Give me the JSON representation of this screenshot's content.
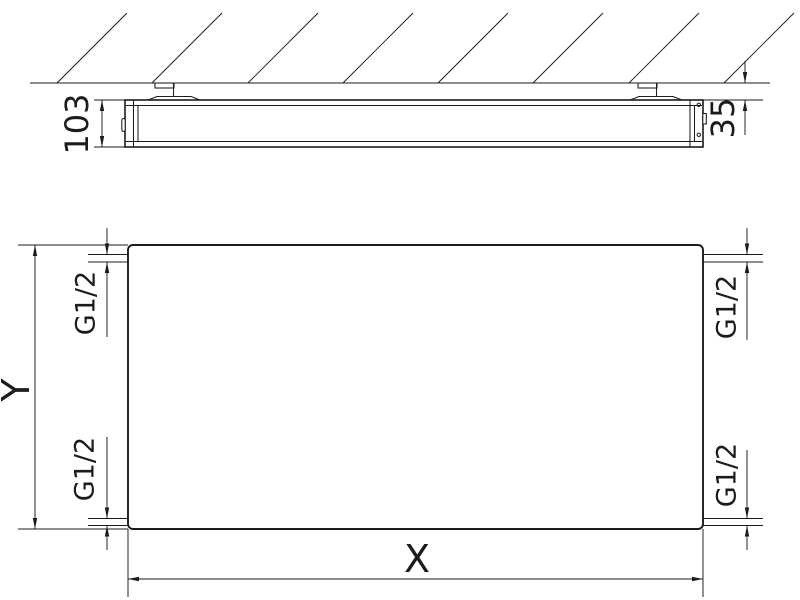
{
  "drawing": {
    "top_view": {
      "depth": "103",
      "wall_clearance": "35"
    },
    "front_view": {
      "width": "X",
      "height": "Y"
    },
    "connections": {
      "top_left": "G1/2",
      "top_right": "G1/2",
      "bottom_left": "G1/2",
      "bottom_right": "G1/2"
    },
    "colors": {
      "line": "#1c1c1c",
      "background": "#ffffff"
    }
  }
}
